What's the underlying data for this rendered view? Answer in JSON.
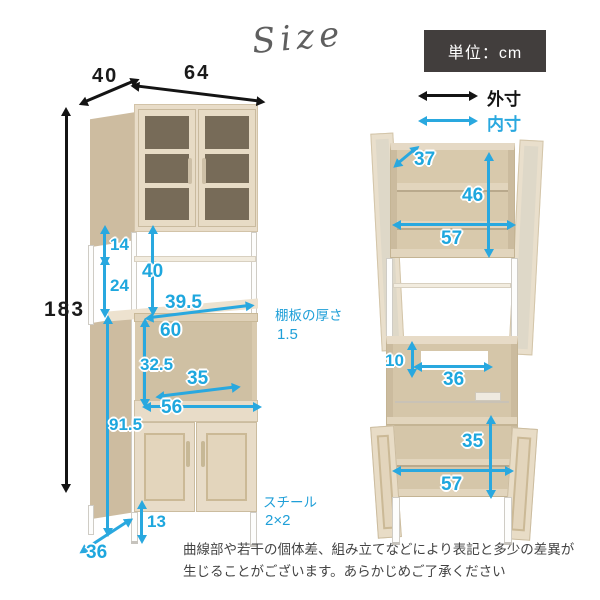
{
  "title": {
    "script": "Size"
  },
  "legend": {
    "unit": "単位：cm",
    "outer": "外寸",
    "inner": "内寸"
  },
  "colors": {
    "accent_blue": "#29a8df",
    "black": "#141414",
    "unit_box_bg": "#423e3d",
    "wood": "#e8dcc8"
  },
  "perspective": {
    "width": "64",
    "depth": "40",
    "height": "183",
    "gap_top": "14",
    "gap_bottom": "24",
    "open_height": "40",
    "counter_depth": "39.5",
    "counter_label": "60",
    "mw_height": "32.5",
    "mw_depth": "35",
    "mw_width": "56",
    "lower_height": "91.5",
    "leg_height": "13",
    "base_depth": "36",
    "shelf_note_label": "棚板の厚さ",
    "shelf_note_value": "1.5",
    "steel_note_label": "スチール",
    "steel_note_value": "2×2"
  },
  "front": {
    "top_depth": "37",
    "top_inner_height": "46",
    "top_inner_width": "57",
    "hole_height": "10",
    "hole_width": "36",
    "bottom_inner_height": "35",
    "bottom_inner_width": "57"
  },
  "disclaimer": {
    "line1": "曲線部や若干の個体差、組み立てなどにより表記と多少の差異が",
    "line2": "生じることがございます。あらかじめご了承ください"
  }
}
